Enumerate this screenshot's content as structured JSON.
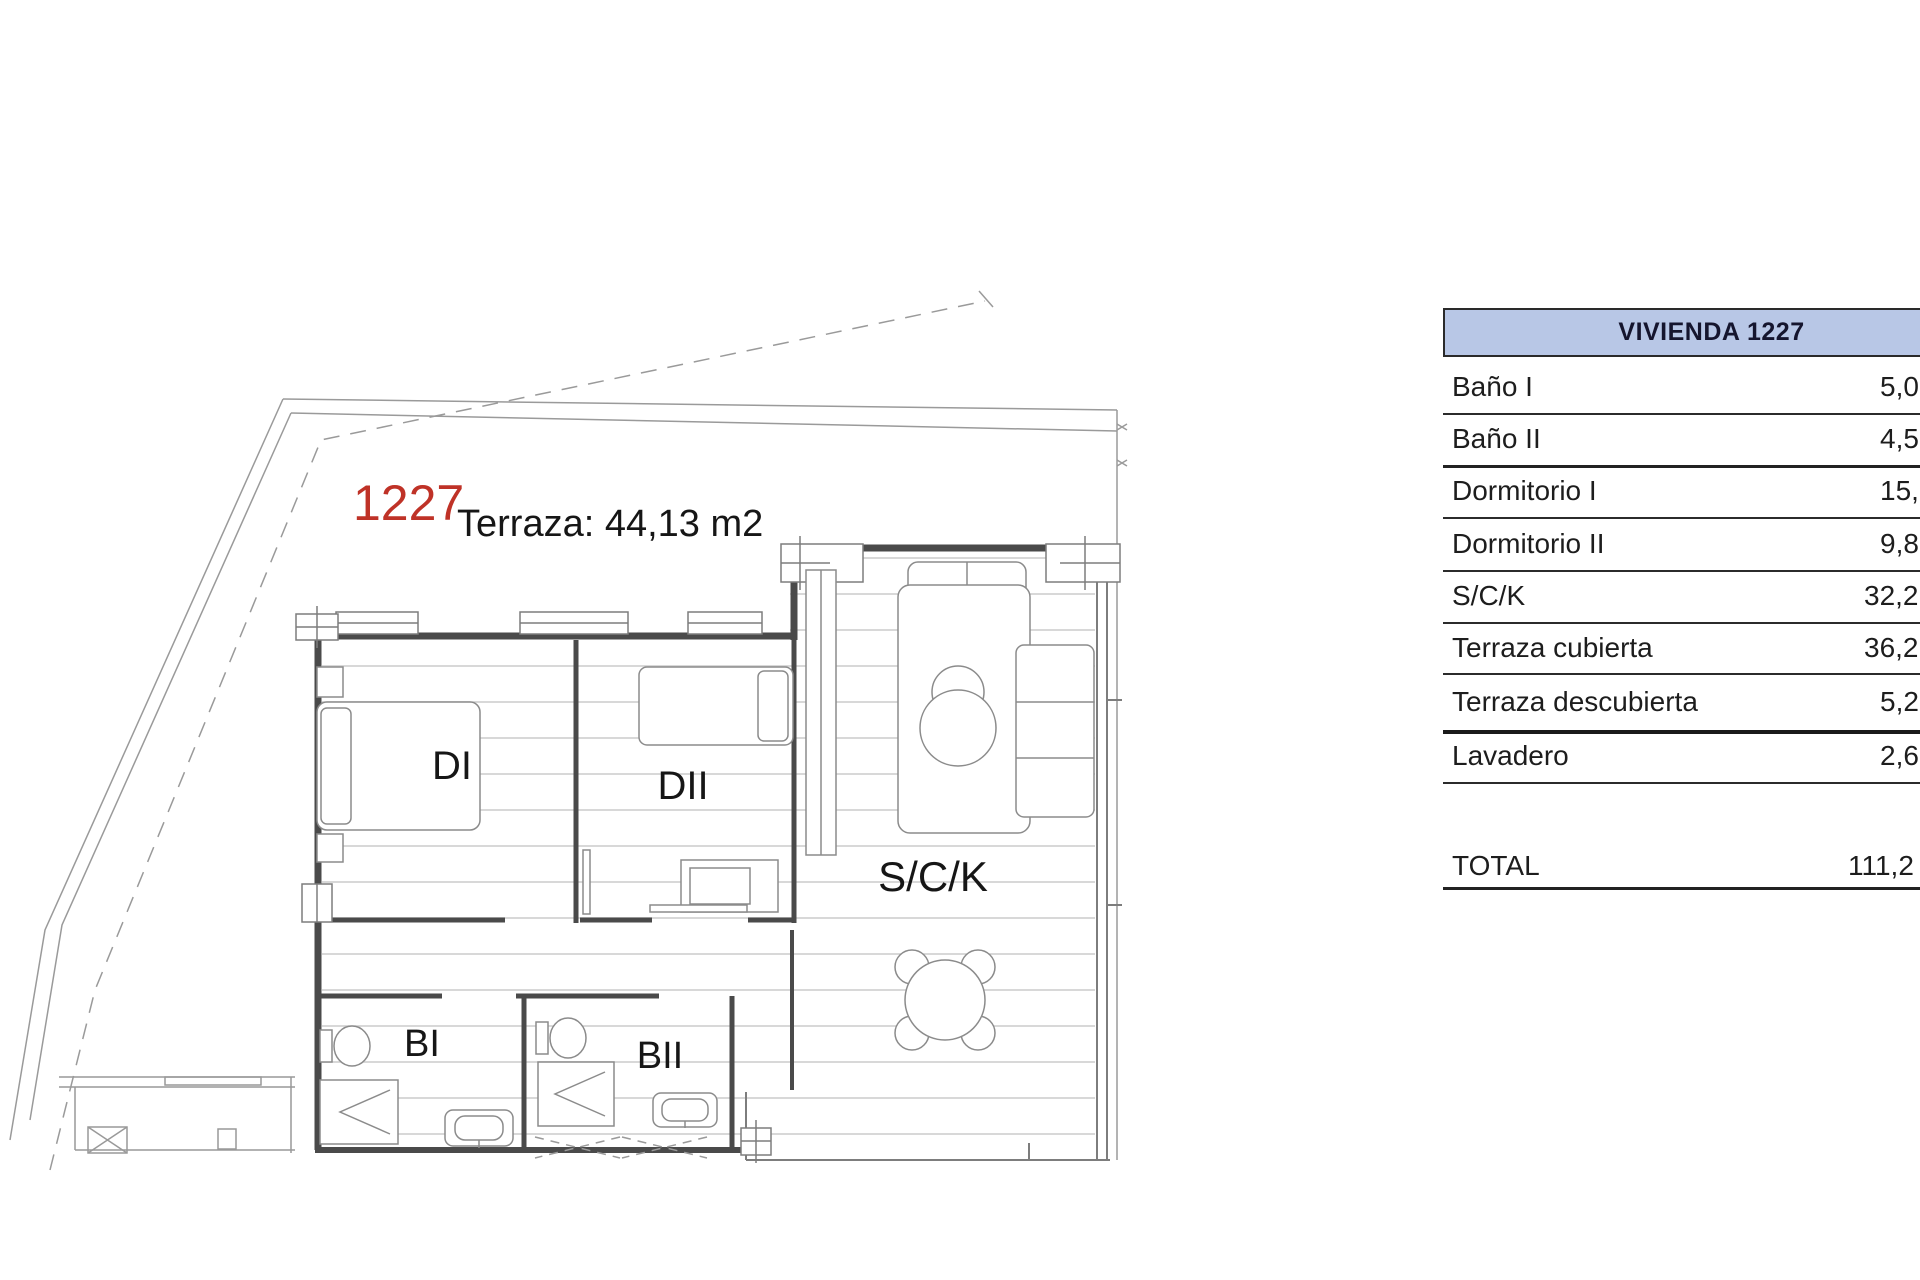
{
  "plan": {
    "unit_number": "1227",
    "terrace_note": "Terraza: 44,13 m2",
    "accent_red": "#bf3227",
    "rooms": {
      "dormitorio1": "DI",
      "dormitorio2": "DII",
      "salon_cocina": "S/C/K",
      "bano1": "BI",
      "bano2": "BII"
    }
  },
  "table": {
    "header": "VIVIENDA 1227",
    "header_bg": "#b8c7e6",
    "rows": [
      {
        "label": "Baño I",
        "value": "5,0"
      },
      {
        "label": "Baño II",
        "value": "4,5"
      },
      {
        "label": "Dormitorio I",
        "value": "15,"
      },
      {
        "label": "Dormitorio II",
        "value": "9,8"
      },
      {
        "label": "S/C/K",
        "value": "32,2"
      },
      {
        "label": "Terraza cubierta",
        "value": "36,2"
      },
      {
        "label": "Terraza descubierta",
        "value": "5,2"
      },
      {
        "label": "Lavadero",
        "value": "2,6"
      }
    ],
    "total_label": "TOTAL",
    "total_value": "111,2"
  }
}
